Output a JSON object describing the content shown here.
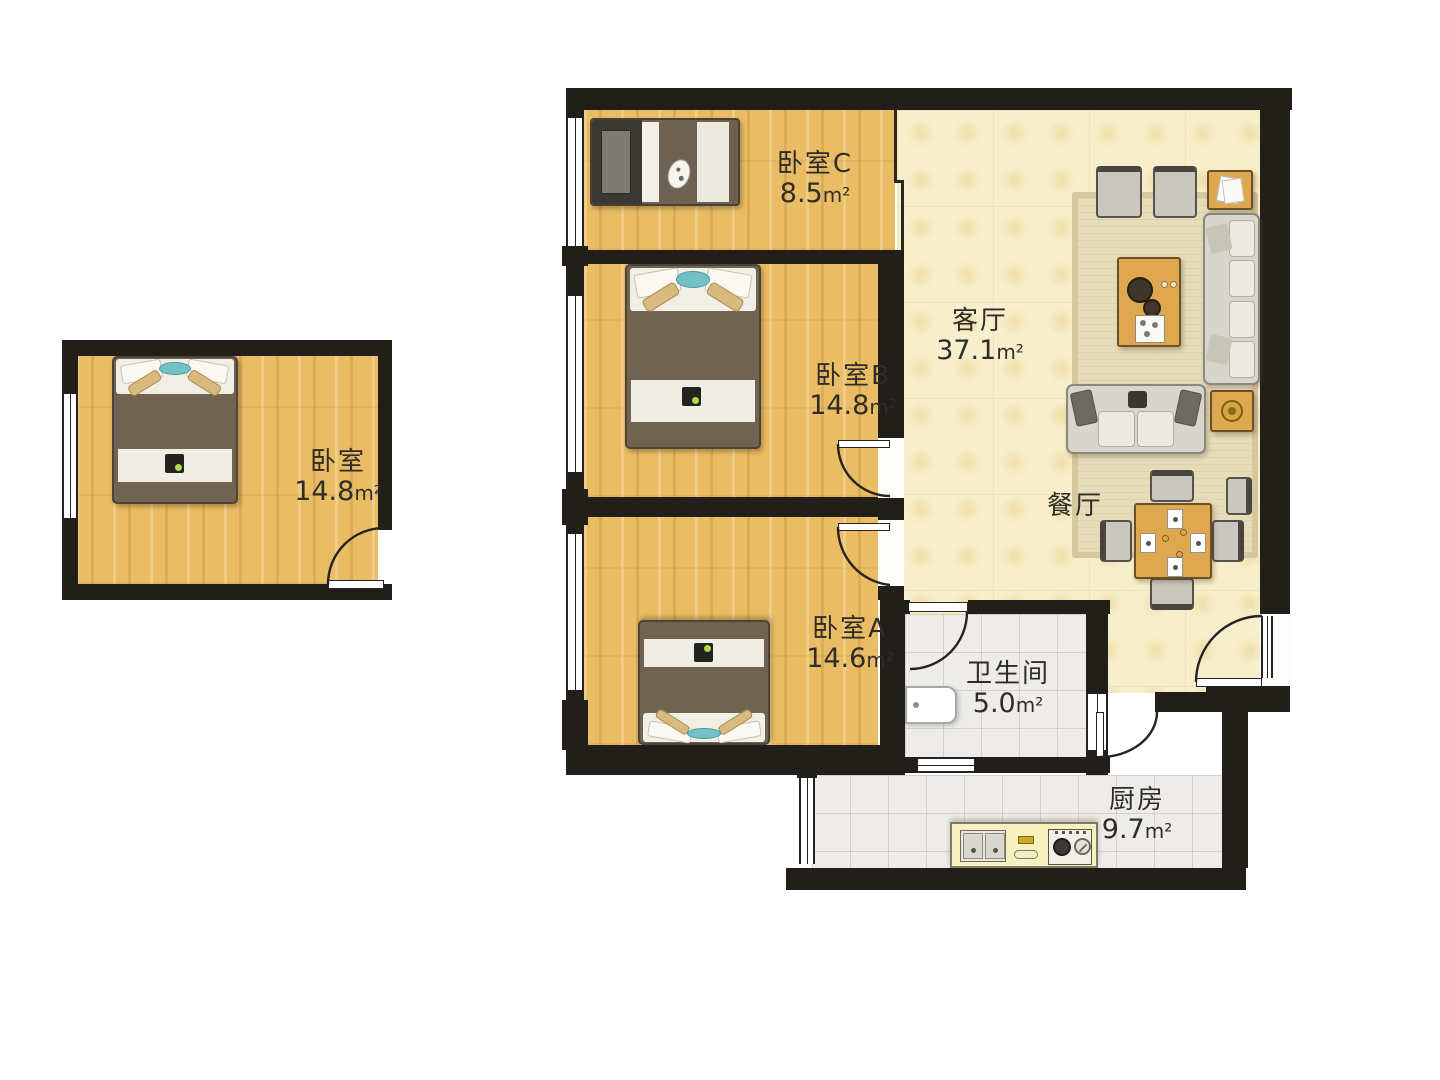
{
  "title": "户型图",
  "area_unit": "m²",
  "rooms": {
    "bedroom_c": {
      "label": "卧室C",
      "area": "8.5"
    },
    "living": {
      "label": "客厅",
      "area": "37.1"
    },
    "bedroom_b": {
      "label": "卧室B",
      "area": "14.8"
    },
    "bedroom_a": {
      "label": "卧室A",
      "area": "14.6"
    },
    "dining": {
      "label": "餐厅"
    },
    "bathroom": {
      "label": "卫生间",
      "area": "5.0"
    },
    "kitchen": {
      "label": "厨房",
      "area": "9.7"
    },
    "bedroom_detached": {
      "label": "卧室",
      "area": "14.8"
    }
  },
  "colors": {
    "wall": "#221f1b",
    "wood": "#eabc63",
    "cream": "#f7eecb",
    "tile": "#edece8",
    "counter": "#f7f1c0",
    "table": "#dfa84f",
    "sofa": "#d8d5cb",
    "teal": "#72c1c7",
    "blanket": "#70634f",
    "label": "#2f2d29"
  }
}
